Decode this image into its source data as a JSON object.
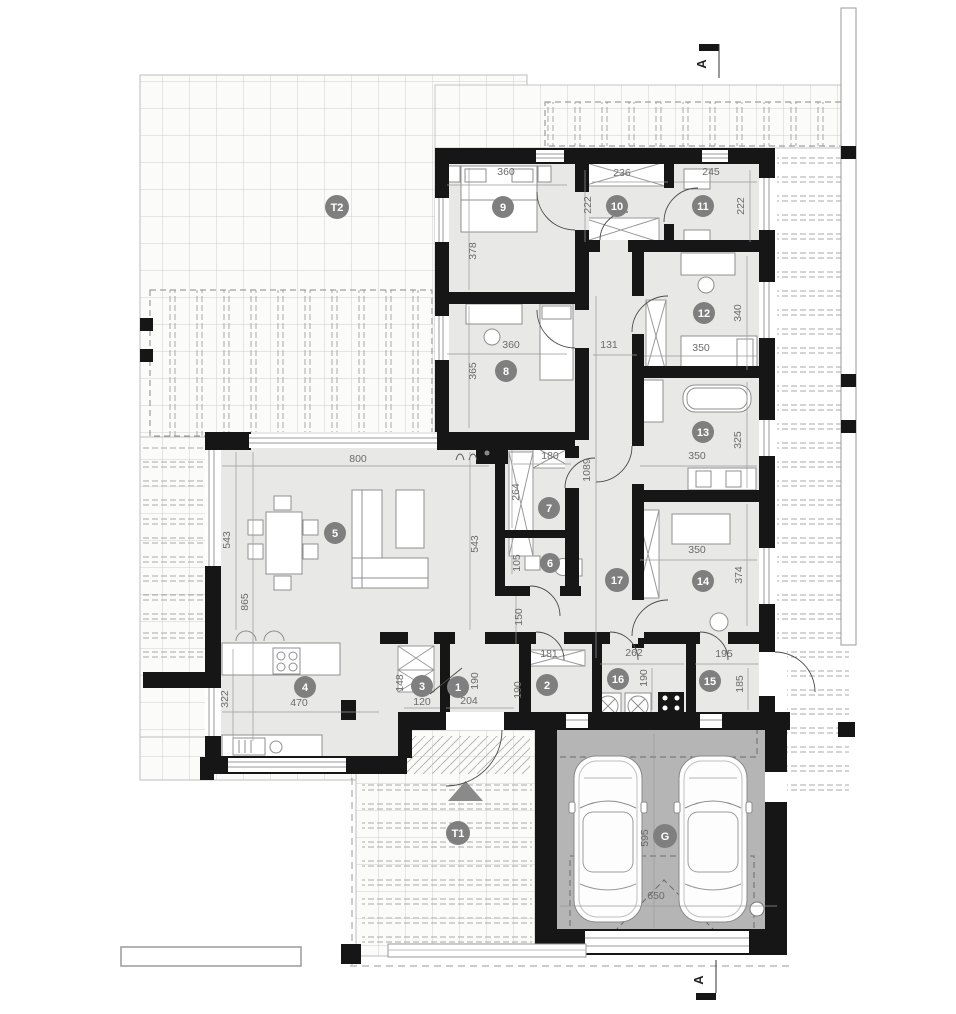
{
  "badges": {
    "room1": "1",
    "room2": "2",
    "room3": "3",
    "room4": "4",
    "room5": "5",
    "room6": "6",
    "room7": "7",
    "room8": "8",
    "room9": "9",
    "room10": "10",
    "room11": "11",
    "room12": "12",
    "room13": "13",
    "room14": "14",
    "room15": "15",
    "room16": "16",
    "room17": "17",
    "terrace1": "T1",
    "terrace2": "T2",
    "garage": "G"
  },
  "dims": {
    "living_width": "800",
    "living_depth_left": "543",
    "living_side_total": "865",
    "living_depth_right": "543",
    "kitchen_width": "470",
    "kitchen_depth": "322",
    "storage_width": "120",
    "storage_depth": "148",
    "vestibule_width": "204",
    "vestibule_depth": "190",
    "room2_width": "181",
    "room2_depth": "190",
    "laundry_width": "262",
    "laundry_depth": "190",
    "utility_width": "195",
    "utility_depth": "185",
    "wc_depth": "105",
    "corridor_lower_depth": "150",
    "closet_width": "180",
    "closet_depth": "264",
    "corridor_length": "1089",
    "corridor_width": "131",
    "room9_width": "360",
    "room9_depth": "378",
    "room8_width": "360",
    "room8_depth": "365",
    "room10_width": "236",
    "room10_depth": "222",
    "room11_width": "245",
    "room11_depth": "222",
    "room12_width": "350",
    "room12_depth": "340",
    "bath_width": "350",
    "bath_depth": "325",
    "room14_width": "350",
    "room14_depth": "374",
    "garage_width": "650",
    "garage_depth": "595"
  },
  "section": {
    "label": "A"
  },
  "colors": {
    "wall": "#161616",
    "floor": "#e8e8e6",
    "garage_floor": "#b5b5b5",
    "badge": "#7f7f7f",
    "dim_text": "#6b6b6b",
    "hatch": "#a9a9a9"
  }
}
